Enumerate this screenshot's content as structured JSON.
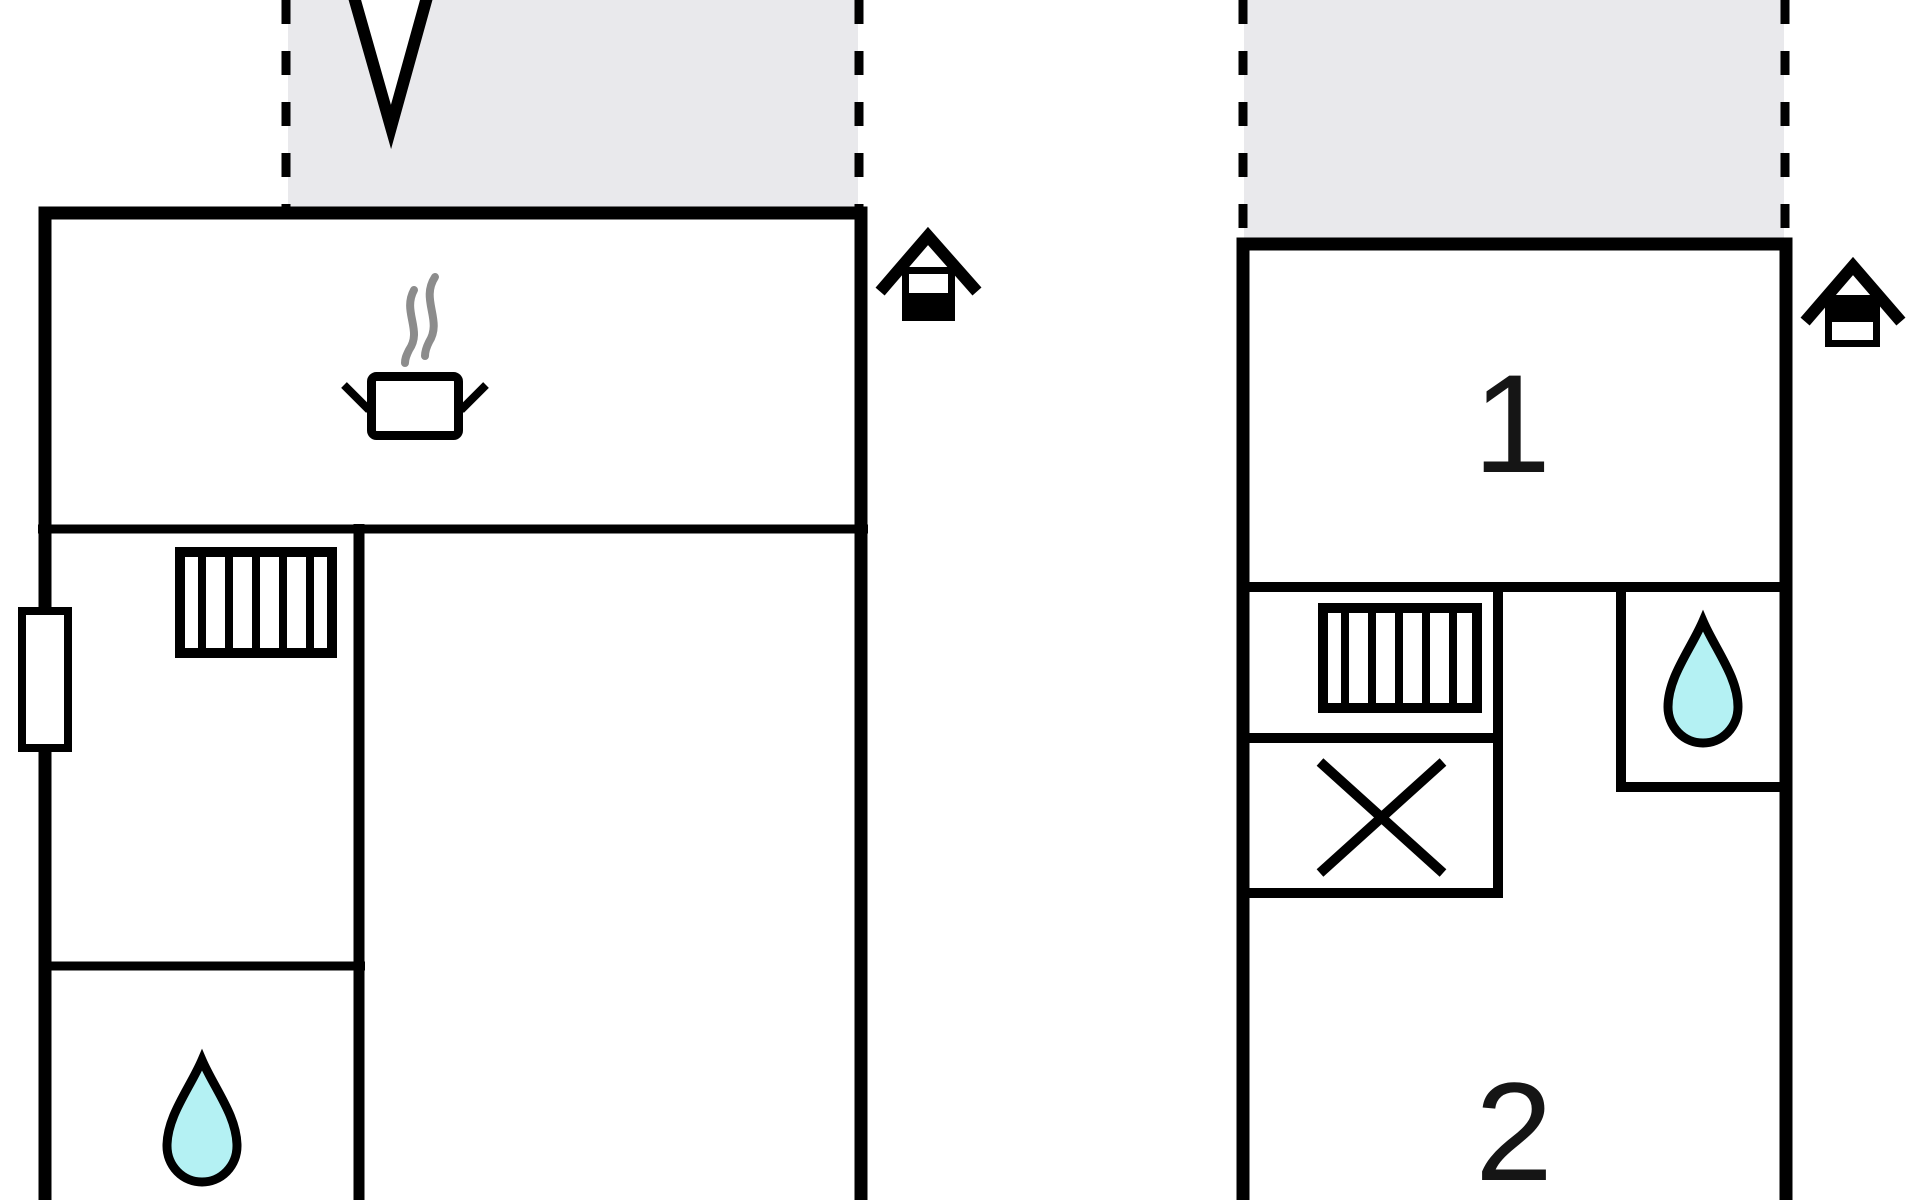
{
  "document": {
    "type": "floor-plan",
    "background": "#ffffff"
  },
  "palette": {
    "paper": "#ffffff",
    "wall": "#000000",
    "terrace_fill": "#e9e9ec",
    "water": "#b4f1f3",
    "steam": "#8c8c8c"
  },
  "labels": {
    "room1": "1",
    "room2": "2"
  },
  "buildings": [
    {
      "name": "main-building",
      "icons": [
        "terrace-dashed-area",
        "entrance-arrow",
        "cooking-pot",
        "steam",
        "stairs",
        "door",
        "water-drop",
        "chimney-house"
      ]
    },
    {
      "name": "annex-building",
      "icons": [
        "terrace-dashed-area",
        "stairs",
        "cross-box",
        "water-drop",
        "chimney-house"
      ],
      "rooms": [
        "1",
        "2"
      ]
    }
  ]
}
